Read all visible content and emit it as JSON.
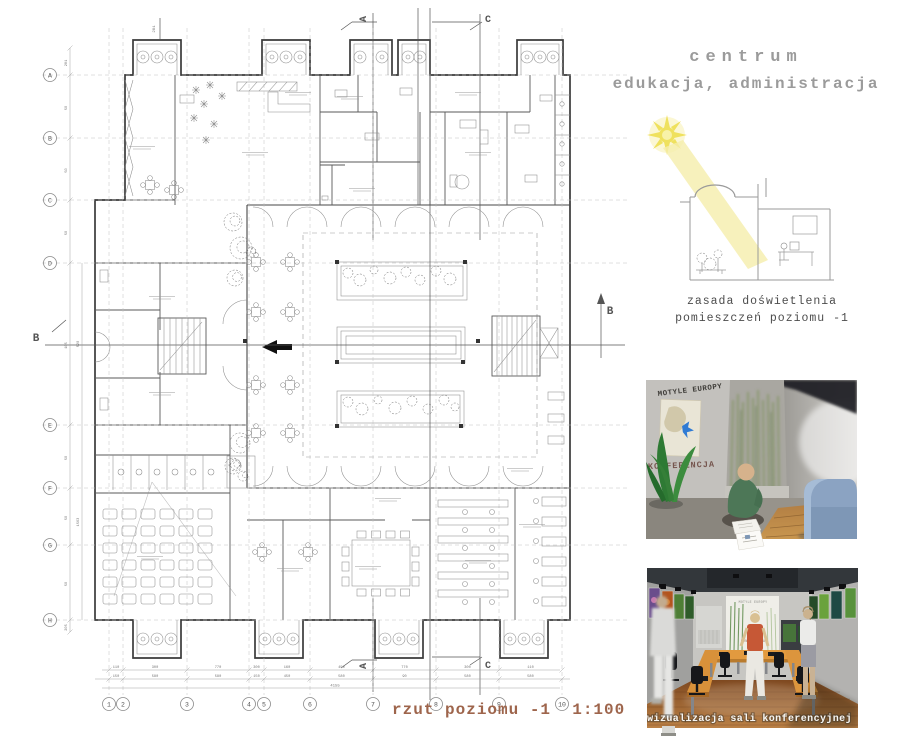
{
  "header": {
    "title_line1": "centrum",
    "title_line2": "edukacja, administracja"
  },
  "sketch": {
    "caption_line1": "zasada doświetlenia",
    "caption_line2": "pomieszczeń poziomu -1"
  },
  "plan": {
    "caption": "rzut poziomu -1  1:100",
    "grid_letters": [
      "A",
      "B",
      "C",
      "D",
      "E",
      "F",
      "G",
      "H"
    ],
    "grid_numbers": [
      "1",
      "2",
      "3",
      "4",
      "5",
      "6",
      "7",
      "8",
      "9",
      "10"
    ],
    "section_marker_a": "A",
    "section_marker_b": "B",
    "section_marker_c": "C",
    "dims_bottom_row1": [
      "110",
      "300",
      "770",
      "300",
      "160",
      "450",
      "770",
      "300",
      "110"
    ],
    "dims_bottom_row2": [
      "150",
      "580",
      "580",
      "150",
      "450",
      "580",
      "90",
      "580",
      "580"
    ],
    "dims_bottom_total": "4155",
    "dims_left": [
      "281",
      "50",
      "50",
      "50",
      "105",
      "50",
      "50",
      "50",
      "205"
    ],
    "dims_left2": [
      "520",
      "1563"
    ],
    "dim_top_left": "281"
  },
  "viz1": {
    "wall_title": "MOTYLE EUROPY",
    "wall_subtitle": "KONFERENCJA"
  },
  "viz2": {
    "caption": "wizualizacja sali konferencyjnej",
    "banner_title": "MOTYLE EUROPY",
    "banner_subtitle": "KONFERENCJA"
  },
  "colors": {
    "plan_caption": "#9e654c",
    "title_grey": "#9b9b9b",
    "sun_yellow": "#efe15e",
    "beam_yellow": "#f5eeab",
    "butterfly_blue": "#2f7bd4"
  }
}
